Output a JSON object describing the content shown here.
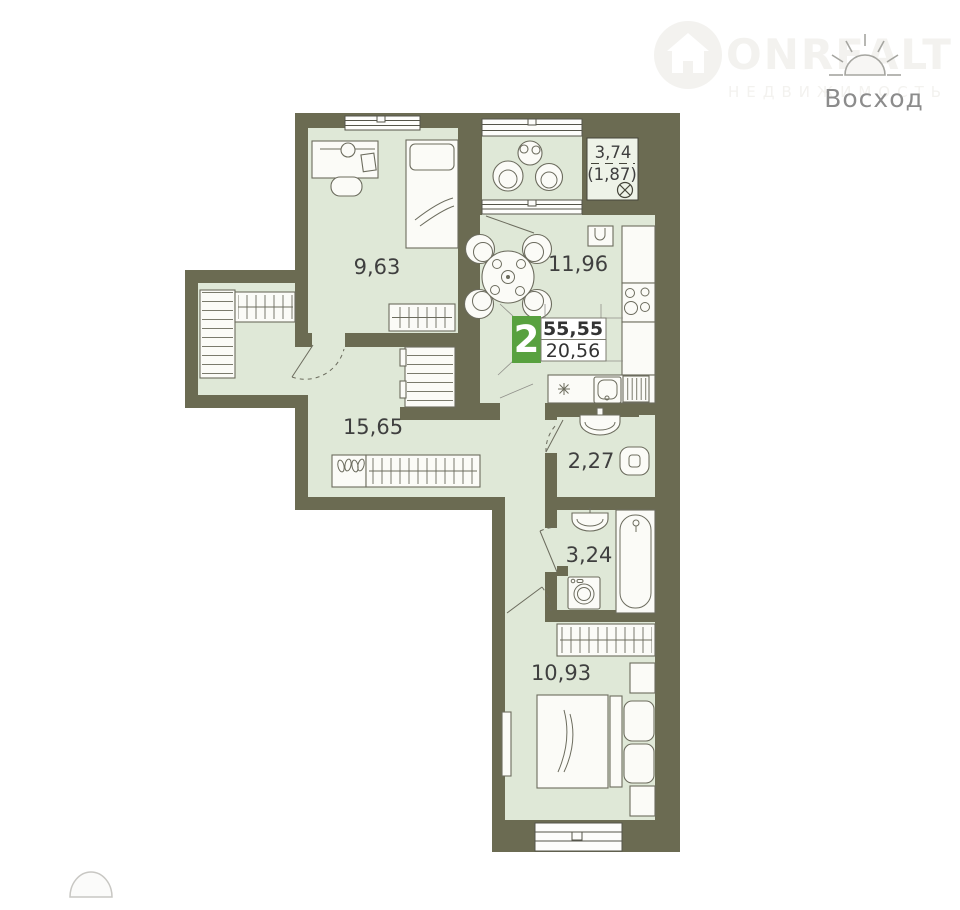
{
  "branding": {
    "logo_text": "ONREALT",
    "logo_subtext": "НЕДВИЖИМОСТЬ",
    "project_name": "Восход"
  },
  "badge": {
    "rooms_count": "2",
    "total_area": "55,55",
    "living_area": "20,56"
  },
  "rooms": [
    {
      "id": "room",
      "area": "9,63"
    },
    {
      "id": "kitchen",
      "area": "11,96"
    },
    {
      "id": "balcony",
      "area": "3,74",
      "area_reduced": "(1,87)"
    },
    {
      "id": "hallway",
      "area": "15,65"
    },
    {
      "id": "wc",
      "area": "2,27"
    },
    {
      "id": "bathroom",
      "area": "3,24"
    },
    {
      "id": "bedroom",
      "area": "10,93"
    }
  ],
  "colors": {
    "wall": "#6b6b52",
    "floor": "#dfe8d7",
    "badge_accent": "#58a13f",
    "label_text": "#3f3f3f",
    "watermark": "#f3f2ef",
    "brand_text": "#8c8c8c"
  }
}
